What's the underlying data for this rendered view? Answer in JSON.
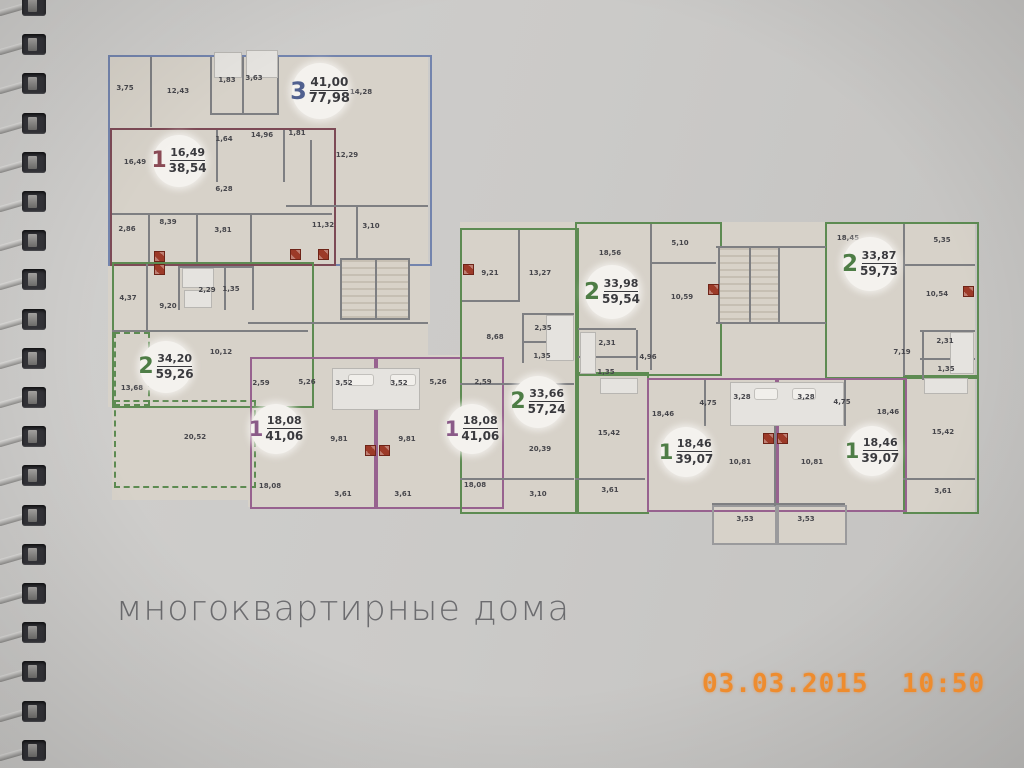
{
  "page": {
    "title": "многоквартирные дома",
    "camera_timestamp": "03.03.2015  10:50"
  },
  "colors": {
    "page_bg": "#cac9c7",
    "plan_fill": "#d7d2c9",
    "wall": "#7e7f82",
    "title": "#6c6c6f",
    "stamp": "#ee8c2e",
    "stove": "#9c3a28",
    "badge_bg": "#f4f2ee",
    "outline_blue": "#7384ad",
    "outline_green": "#5d8b52",
    "outline_purple": "#97628f",
    "outline_maroon": "#7d4a56",
    "outline_gray": "#9a9a9c",
    "badge_blue": "#50608f",
    "badge_green": "#4e7d46",
    "badge_purple": "#8a5a88",
    "badge_maroon": "#8a4a55"
  },
  "plan": {
    "badges": [
      {
        "num": "3",
        "top": "41,00",
        "bottom": "77,98",
        "color": "blue",
        "x": 320,
        "y": 91,
        "d": 56
      },
      {
        "num": "1",
        "top": "16,49",
        "bottom": "38,54",
        "color": "maroon",
        "x": 179,
        "y": 161,
        "d": 52
      },
      {
        "num": "2",
        "top": "34,20",
        "bottom": "59,26",
        "color": "green",
        "x": 166,
        "y": 367,
        "d": 52
      },
      {
        "num": "1",
        "top": "18,08",
        "bottom": "41,06",
        "color": "purple",
        "x": 276,
        "y": 429,
        "d": 50
      },
      {
        "num": "1",
        "top": "18,08",
        "bottom": "41,06",
        "color": "purple",
        "x": 472,
        "y": 429,
        "d": 50
      },
      {
        "num": "2",
        "top": "33,66",
        "bottom": "57,24",
        "color": "green",
        "x": 538,
        "y": 402,
        "d": 52
      },
      {
        "num": "2",
        "top": "33,98",
        "bottom": "59,54",
        "color": "green",
        "x": 612,
        "y": 292,
        "d": 54
      },
      {
        "num": "2",
        "top": "33,87",
        "bottom": "59,73",
        "color": "green",
        "x": 870,
        "y": 264,
        "d": 54
      },
      {
        "num": "1",
        "top": "18,46",
        "bottom": "39,07",
        "color": "green",
        "x": 686,
        "y": 452,
        "d": 50
      },
      {
        "num": "1",
        "top": "18,46",
        "bottom": "39,07",
        "color": "green",
        "x": 872,
        "y": 451,
        "d": 50
      }
    ],
    "dims": [
      {
        "v": "3,75",
        "x": 125,
        "y": 88
      },
      {
        "v": "12,43",
        "x": 178,
        "y": 91
      },
      {
        "v": "1,83",
        "x": 227,
        "y": 80
      },
      {
        "v": "3,63",
        "x": 254,
        "y": 78
      },
      {
        "v": "14,28",
        "x": 361,
        "y": 92
      },
      {
        "v": "14,96",
        "x": 262,
        "y": 135
      },
      {
        "v": "1,81",
        "x": 297,
        "y": 133
      },
      {
        "v": "12,29",
        "x": 347,
        "y": 155
      },
      {
        "v": "1,64",
        "x": 224,
        "y": 139
      },
      {
        "v": "16,49",
        "x": 135,
        "y": 162
      },
      {
        "v": "6,28",
        "x": 224,
        "y": 189
      },
      {
        "v": "11,32",
        "x": 323,
        "y": 225
      },
      {
        "v": "3,10",
        "x": 371,
        "y": 226
      },
      {
        "v": "2,86",
        "x": 127,
        "y": 229
      },
      {
        "v": "8,39",
        "x": 168,
        "y": 222
      },
      {
        "v": "3,81",
        "x": 223,
        "y": 230
      },
      {
        "v": "2,29",
        "x": 207,
        "y": 290
      },
      {
        "v": "1,35",
        "x": 231,
        "y": 289
      },
      {
        "v": "4,37",
        "x": 128,
        "y": 298
      },
      {
        "v": "9,20",
        "x": 168,
        "y": 306
      },
      {
        "v": "10,12",
        "x": 221,
        "y": 352
      },
      {
        "v": "13,68",
        "x": 132,
        "y": 388
      },
      {
        "v": "20,52",
        "x": 195,
        "y": 437
      },
      {
        "v": "2,59",
        "x": 261,
        "y": 383
      },
      {
        "v": "5,26",
        "x": 307,
        "y": 382
      },
      {
        "v": "3,52",
        "x": 344,
        "y": 383
      },
      {
        "v": "3,52",
        "x": 399,
        "y": 383
      },
      {
        "v": "5,26",
        "x": 438,
        "y": 382
      },
      {
        "v": "2,59",
        "x": 483,
        "y": 382
      },
      {
        "v": "9,81",
        "x": 339,
        "y": 439
      },
      {
        "v": "9,81",
        "x": 407,
        "y": 439
      },
      {
        "v": "18,08",
        "x": 270,
        "y": 486
      },
      {
        "v": "18,08",
        "x": 475,
        "y": 485
      },
      {
        "v": "3,61",
        "x": 343,
        "y": 494
      },
      {
        "v": "3,61",
        "x": 403,
        "y": 494
      },
      {
        "v": "9,21",
        "x": 490,
        "y": 273
      },
      {
        "v": "13,27",
        "x": 540,
        "y": 273
      },
      {
        "v": "2,35",
        "x": 543,
        "y": 328
      },
      {
        "v": "1,35",
        "x": 542,
        "y": 356
      },
      {
        "v": "8,68",
        "x": 495,
        "y": 337
      },
      {
        "v": "20,39",
        "x": 540,
        "y": 449
      },
      {
        "v": "3,10",
        "x": 538,
        "y": 494
      },
      {
        "v": "18,56",
        "x": 610,
        "y": 253
      },
      {
        "v": "5,10",
        "x": 680,
        "y": 243
      },
      {
        "v": "10,59",
        "x": 682,
        "y": 297
      },
      {
        "v": "2,31",
        "x": 607,
        "y": 343
      },
      {
        "v": "1,35",
        "x": 606,
        "y": 372
      },
      {
        "v": "4,96",
        "x": 648,
        "y": 357
      },
      {
        "v": "15,42",
        "x": 609,
        "y": 433
      },
      {
        "v": "3,61",
        "x": 610,
        "y": 490
      },
      {
        "v": "18,45",
        "x": 848,
        "y": 238
      },
      {
        "v": "5,35",
        "x": 942,
        "y": 240
      },
      {
        "v": "10,54",
        "x": 937,
        "y": 294
      },
      {
        "v": "2,31",
        "x": 945,
        "y": 341
      },
      {
        "v": "1,35",
        "x": 946,
        "y": 369
      },
      {
        "v": "7,19",
        "x": 902,
        "y": 352
      },
      {
        "v": "15,42",
        "x": 943,
        "y": 432
      },
      {
        "v": "3,61",
        "x": 943,
        "y": 491
      },
      {
        "v": "18,46",
        "x": 663,
        "y": 414
      },
      {
        "v": "18,46",
        "x": 888,
        "y": 412
      },
      {
        "v": "4,75",
        "x": 708,
        "y": 403
      },
      {
        "v": "4,75",
        "x": 842,
        "y": 402
      },
      {
        "v": "3,28",
        "x": 742,
        "y": 397
      },
      {
        "v": "3,28",
        "x": 806,
        "y": 397
      },
      {
        "v": "10,81",
        "x": 740,
        "y": 462
      },
      {
        "v": "10,81",
        "x": 812,
        "y": 462
      },
      {
        "v": "3,53",
        "x": 745,
        "y": 519
      },
      {
        "v": "3,53",
        "x": 806,
        "y": 519
      }
    ],
    "stoves": [
      {
        "x": 154,
        "y": 251
      },
      {
        "x": 154,
        "y": 264
      },
      {
        "x": 290,
        "y": 249
      },
      {
        "x": 318,
        "y": 249
      },
      {
        "x": 365,
        "y": 445
      },
      {
        "x": 379,
        "y": 445
      },
      {
        "x": 463,
        "y": 264
      },
      {
        "x": 708,
        "y": 284
      },
      {
        "x": 763,
        "y": 433
      },
      {
        "x": 777,
        "y": 433
      },
      {
        "x": 963,
        "y": 286
      }
    ]
  }
}
